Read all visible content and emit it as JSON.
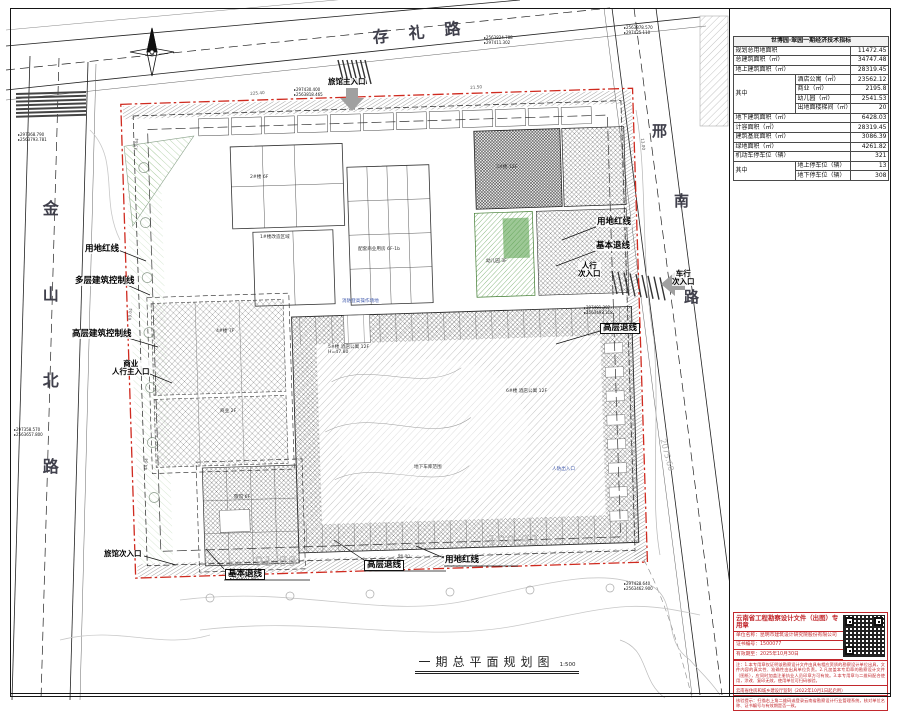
{
  "sheet": {
    "caption": "一期总平面规划图",
    "caption_scale": "1:500"
  },
  "colors": {
    "boundary_red": "#cf2a1f",
    "stamp_red": "#c2282d",
    "green": "#4d9a40"
  },
  "indicators": {
    "title": "世博园·翠园一期经济技术指标",
    "rows": [
      [
        {
          "t": "规划总用地面积",
          "cs": 2
        },
        {
          "t": "11472.45",
          "num": true
        }
      ],
      [
        {
          "t": "总建筑面积（㎡）",
          "cs": 2
        },
        {
          "t": "34747.48",
          "num": true
        }
      ],
      [
        {
          "t": "地上建筑面积（㎡）",
          "cs": 2
        },
        {
          "t": "28319.45",
          "num": true
        }
      ],
      [
        {
          "t": "其中",
          "rs": 4,
          "c": "mid"
        },
        {
          "t": "酒店公寓（㎡）"
        },
        {
          "t": "23562.12",
          "num": true
        }
      ],
      [
        {
          "t": "商业（㎡）"
        },
        {
          "t": "2195.8",
          "num": true
        }
      ],
      [
        {
          "t": "幼儿园（㎡）"
        },
        {
          "t": "2541.53",
          "num": true
        }
      ],
      [
        {
          "t": "出地面楼梯间（㎡）"
        },
        {
          "t": "20",
          "num": true
        }
      ],
      [
        {
          "t": "地下建筑面积（㎡）",
          "cs": 2
        },
        {
          "t": "6428.03",
          "num": true
        }
      ],
      [
        {
          "t": "计容面积（㎡）",
          "cs": 2
        },
        {
          "t": "28319.45",
          "num": true
        }
      ],
      [
        {
          "t": "建筑基底面积（㎡）",
          "cs": 2
        },
        {
          "t": "3086.39",
          "num": true
        }
      ],
      [
        {
          "t": "绿地面积（㎡）",
          "cs": 2
        },
        {
          "t": "4261.82",
          "num": true
        }
      ],
      [
        {
          "t": "机动车停车位（辆）",
          "cs": 2
        },
        {
          "t": "321",
          "num": true
        }
      ],
      [
        {
          "t": "其中",
          "rs": 2,
          "c": "mid"
        },
        {
          "t": "地上停车位（辆）"
        },
        {
          "t": "13",
          "num": true
        }
      ],
      [
        {
          "t": "地下停车位（辆）"
        },
        {
          "t": "308",
          "num": true
        }
      ]
    ]
  },
  "stamp": {
    "title": "云南省工程勘察设计文件（出图）专用章",
    "fields": [
      "单位名称：昆明市建筑设计研究院股份有限公司",
      "证书编号：1500077",
      "有效期至：2025年10月30日"
    ],
    "notice": "注：1.本专用章仅证明该勘察设计文件由具有相应资质的勘察设计单位出具，文件内容的真实性、准确性由出具单位负责。2.凡加盖本专用章的勘察设计文件（图纸），应同时加盖注册执业人员印章方可有效。3.本专用章与二维码配合使用，涂改、复印无效，使用单位可扫码核验。",
    "footer1": "云南省住房和城乡建设厅监制（2022年10月1日起启用）",
    "footer2": "核验提示：扫描右上角二维码或登录云南省勘察设计行业管理系统，核对单位名称、证书编号与有效期是否一致。"
  },
  "map": {
    "road_names": {
      "top": "存礼路",
      "left": "金山北路",
      "right": "邢南路"
    },
    "labels": [
      {
        "id": "road-name-top",
        "t": "存礼路",
        "x": 372,
        "y": 30,
        "c": "road",
        "rot": -6
      },
      {
        "id": "road-name-left",
        "t": "金山北路",
        "x": 40,
        "y": 200,
        "c": "roadv"
      },
      {
        "id": "road-name-right-char1",
        "t": "邢",
        "x": 652,
        "y": 124,
        "c": "roadchar"
      },
      {
        "id": "road-name-right-char2",
        "t": "南",
        "x": 674,
        "y": 194,
        "c": "roadchar"
      },
      {
        "id": "road-name-right-char3",
        "t": "路",
        "x": 684,
        "y": 290,
        "c": "roadchar"
      },
      {
        "id": "label-yongdi-hongxian-left",
        "t": "用地红线",
        "x": 84,
        "y": 245,
        "c": "bold"
      },
      {
        "id": "label-duoceng-jianzhu-kongzhixian",
        "t": "多层建筑控制线",
        "x": 74,
        "y": 277,
        "c": "bold"
      },
      {
        "id": "label-gaoceng-jianzhu-kongzhixian",
        "t": "高层建筑控制线",
        "x": 71,
        "y": 330,
        "c": "bold"
      },
      {
        "id": "label-shangye-renxing-zhurukou",
        "t": "商业\n人行主入口",
        "x": 112,
        "y": 360,
        "c": "entry"
      },
      {
        "id": "label-lvguan-zhurukou",
        "t": "旅馆主入口",
        "x": 328,
        "y": 78,
        "c": "entry"
      },
      {
        "id": "label-lvguan-cirukou",
        "t": "旅馆次入口",
        "x": 104,
        "y": 550,
        "c": "entry"
      },
      {
        "id": "label-jiben-tuixian-bottom",
        "t": "基本退线",
        "x": 225,
        "y": 569,
        "c": "boxed"
      },
      {
        "id": "label-gaoceng-tuixian-bottom",
        "t": "高层退线",
        "x": 364,
        "y": 560,
        "c": "boxed"
      },
      {
        "id": "label-yongdi-hongxian-bottom",
        "t": "用地红线",
        "x": 444,
        "y": 556,
        "c": "bold"
      },
      {
        "id": "label-yongdi-hongxian-right",
        "t": "用地红线",
        "x": 596,
        "y": 218,
        "c": "bold"
      },
      {
        "id": "label-jiben-tuixian-right",
        "t": "基本退线",
        "x": 595,
        "y": 242,
        "c": "bold"
      },
      {
        "id": "label-renxing-cirukou",
        "t": "人行\n次入口",
        "x": 578,
        "y": 262,
        "c": "entry"
      },
      {
        "id": "label-gaoceng-tuixian-right",
        "t": "高层退线",
        "x": 600,
        "y": 323,
        "c": "boxed"
      },
      {
        "id": "label-chexing-cirukou",
        "t": "车行\n次入口",
        "x": 672,
        "y": 270,
        "c": "entry"
      },
      {
        "id": "elev-91-89",
        "t": "91.89",
        "x": 255,
        "y": 556,
        "c": "elev"
      },
      {
        "id": "elev-100-93",
        "t": "100.93",
        "x": 488,
        "y": 535,
        "c": "elev"
      },
      {
        "id": "elev-2075-60",
        "t": "2075.60",
        "x": 666,
        "y": 438,
        "c": "elev-s",
        "rot": 75
      },
      {
        "id": "anno-bld2",
        "t": "2#楼 6F",
        "x": 250,
        "y": 176,
        "c": "tiny"
      },
      {
        "id": "anno-bld1",
        "t": "1#楼改造区域",
        "x": 260,
        "y": 236,
        "c": "tiny"
      },
      {
        "id": "anno-peitao",
        "t": "配套商业用房 6F-1b",
        "x": 358,
        "y": 248,
        "c": "tiny"
      },
      {
        "id": "anno-bld3",
        "t": "3#楼 12F",
        "x": 496,
        "y": 166,
        "c": "tiny"
      },
      {
        "id": "anno-kindergarten",
        "t": "幼儿园 3F",
        "x": 486,
        "y": 260,
        "c": "tiny"
      },
      {
        "id": "anno-bld5",
        "t": "5#楼 酒店公寓 12F\nH=47.80",
        "x": 328,
        "y": 346,
        "c": "tiny"
      },
      {
        "id": "anno-bld6",
        "t": "6#楼 酒店公寓 12F",
        "x": 506,
        "y": 390,
        "c": "tiny"
      },
      {
        "id": "anno-bld4",
        "t": "4#楼 7F",
        "x": 216,
        "y": 330,
        "c": "tiny"
      },
      {
        "id": "anno-shangye2f",
        "t": "商业 2F",
        "x": 220,
        "y": 410,
        "c": "tiny"
      },
      {
        "id": "anno-lvguan6f",
        "t": "旅馆 6F",
        "x": 234,
        "y": 496,
        "c": "tiny"
      },
      {
        "id": "anno-garage",
        "t": "地下车库范围",
        "x": 414,
        "y": 466,
        "c": "tiny"
      },
      {
        "id": "anno-renfang",
        "t": "人防出入口",
        "x": 552,
        "y": 468,
        "c": "tinyblue"
      },
      {
        "id": "anno-xiaofang",
        "t": "消防登高操作场地",
        "x": 342,
        "y": 300,
        "c": "tinyblue"
      },
      {
        "id": "dim-1",
        "t": "33.64",
        "x": 134,
        "y": 150,
        "c": "dim",
        "rot": -83
      },
      {
        "id": "dim-2",
        "t": "69.04",
        "x": 128,
        "y": 320,
        "c": "dim",
        "rot": -84
      },
      {
        "id": "dim-3",
        "t": "44.04",
        "x": 144,
        "y": 470,
        "c": "dim",
        "rot": -85
      },
      {
        "id": "dim-4",
        "t": "225.40",
        "x": 250,
        "y": 92,
        "c": "dim",
        "rot": -4
      },
      {
        "id": "dim-5",
        "t": "21.50",
        "x": 470,
        "y": 86,
        "c": "dim",
        "rot": -4
      },
      {
        "id": "dim-6",
        "t": "96.00",
        "x": 398,
        "y": 554,
        "c": "dim",
        "rot": 2
      },
      {
        "id": "dim-7",
        "t": "13.00",
        "x": 644,
        "y": 138,
        "c": "dim",
        "rot": 84
      }
    ],
    "coords": [
      {
        "id": "coord-1",
        "x": 484,
        "y": 36,
        "a": "2563824.788",
        "b": "297411.302"
      },
      {
        "id": "coord-2",
        "x": 624,
        "y": 26,
        "a": "2563878.570",
        "b": "297425.110"
      },
      {
        "id": "coord-3",
        "x": 18,
        "y": 133,
        "a": "297368.790",
        "b": "2563793.781"
      },
      {
        "id": "coord-4",
        "x": 14,
        "y": 428,
        "a": "297358.570",
        "b": "2563657.800"
      },
      {
        "id": "coord-5",
        "x": 230,
        "y": 572,
        "a": "297358.577",
        "b": "2563657.805"
      },
      {
        "id": "coord-6",
        "x": 584,
        "y": 306,
        "a": "297491.302",
        "b": "2563493.318"
      },
      {
        "id": "coord-7",
        "x": 624,
        "y": 582,
        "a": "297428.640",
        "b": "2563462.900"
      },
      {
        "id": "coord-8",
        "x": 294,
        "y": 88,
        "a": "297430.400",
        "b": "2563818.465"
      }
    ]
  }
}
